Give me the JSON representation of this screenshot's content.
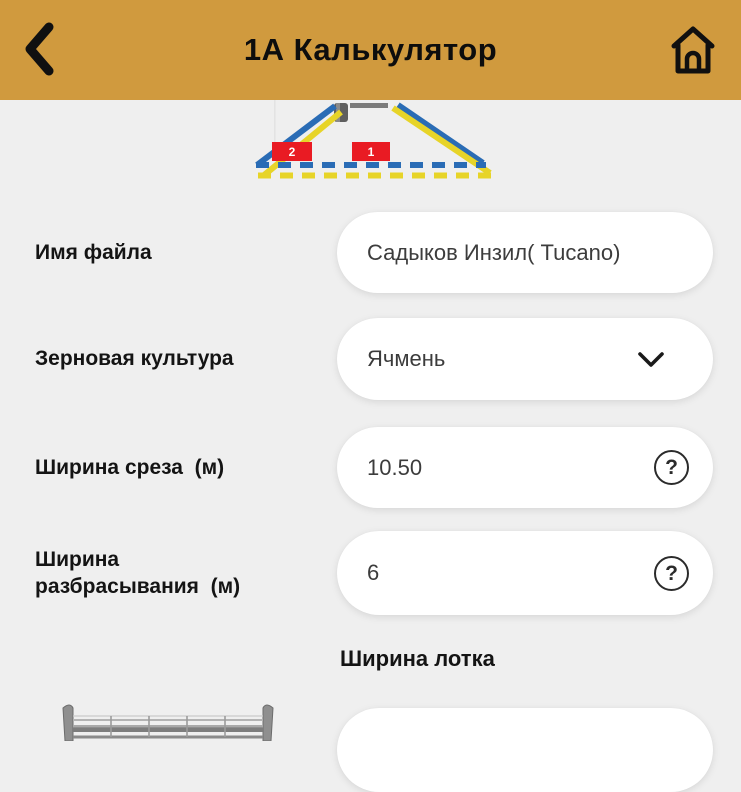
{
  "header": {
    "title": "1А Калькулятор"
  },
  "icons": {
    "back": "back-chevron",
    "home": "home",
    "dropdown": "chevron-down",
    "help": "?"
  },
  "diagram": {
    "marker_left": "2",
    "marker_right": "1"
  },
  "fields": {
    "file_name": {
      "label": "Имя файла",
      "value": "Садыков Инзил( Tucano)"
    },
    "crop": {
      "label": "Зерновая культура",
      "value": "Ячмень"
    },
    "cut_width": {
      "label": "Ширина среза  (м)",
      "value": "10.50"
    },
    "spread_width": {
      "label": "Ширина\nразбрасывания  (м)",
      "value": "6"
    }
  },
  "section": {
    "tray_width_label": "Ширина лотка"
  },
  "colors": {
    "header_bg": "#D09A3E",
    "page_bg": "#EFEFEF",
    "marker_red": "#E91B23",
    "line_blue": "#2A6CB5",
    "line_yellow": "#E7D428",
    "machine_gray": "#8D8D8D"
  }
}
